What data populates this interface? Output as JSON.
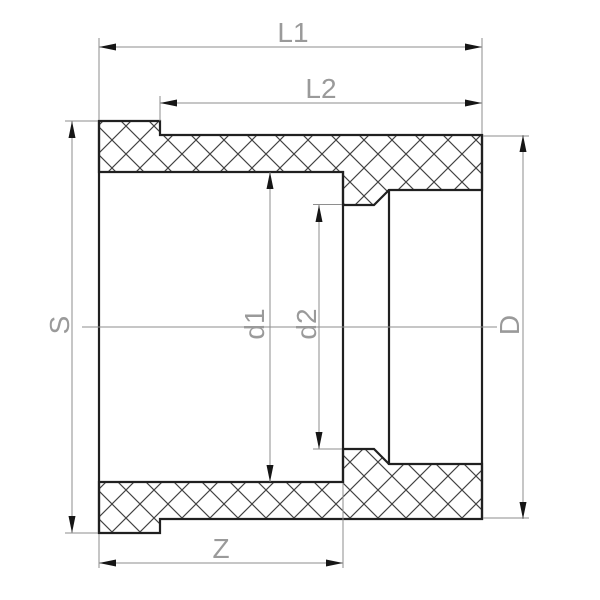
{
  "drawing": {
    "dimension_labels": {
      "l1": "L1",
      "l2": "L2",
      "s": "S",
      "d1": "d1",
      "d2": "d2",
      "d_outer": "D",
      "z": "Z"
    },
    "colors": {
      "background": "#ffffff",
      "part_outline": "#202020",
      "hatch_lines": "#424242",
      "dimension_lines": "#8e8e8e",
      "label_text": "#9a9a9a",
      "arrowheads": "#161616"
    }
  }
}
